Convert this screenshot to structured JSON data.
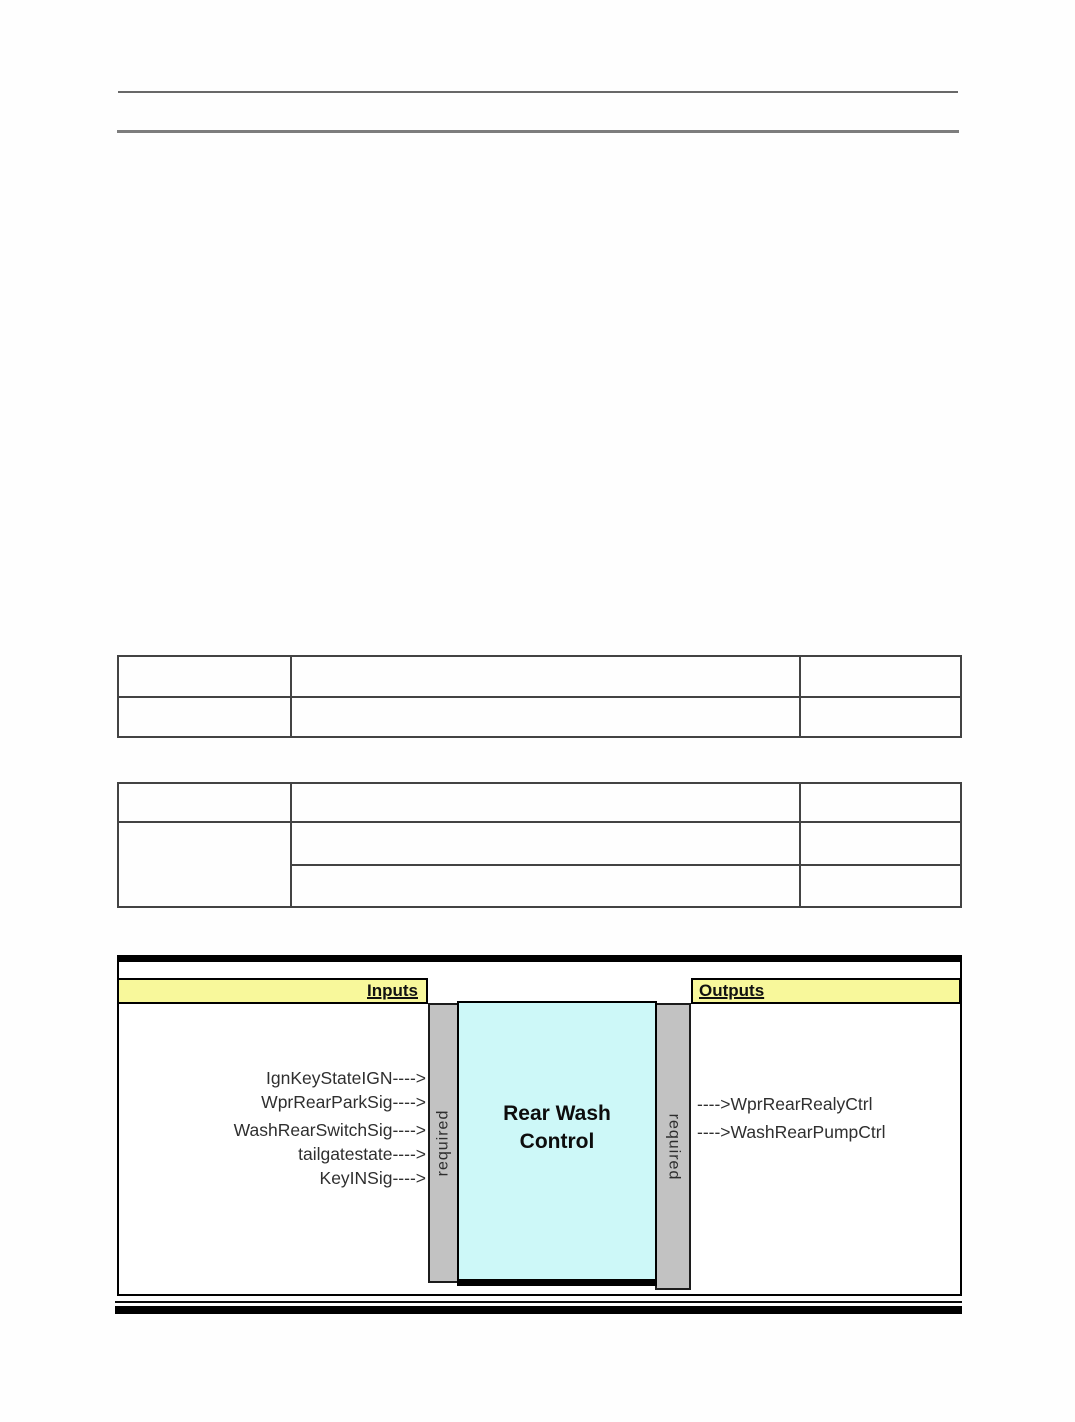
{
  "diagram": {
    "inputs_header": "Inputs",
    "outputs_header": "Outputs",
    "block_name": [
      "Rear Wash",
      "Control"
    ],
    "left_bar_label": "required",
    "right_bar_label": "required",
    "inputs": [
      "IgnKeyStateIGN---->",
      "WprRearParkSig---->",
      "WashRearSwitchSig---->",
      "tailgatestate---->",
      "KeyINSig---->"
    ],
    "outputs": [
      "---->WprRearRealyCtrl",
      "---->WashRearPumpCtrl"
    ],
    "colors": {
      "banner_yellow": "#F8F89B",
      "bar_gray": "#C2C2C2",
      "block_cyan": "#CDF8F8",
      "border_black": "#000000"
    }
  }
}
